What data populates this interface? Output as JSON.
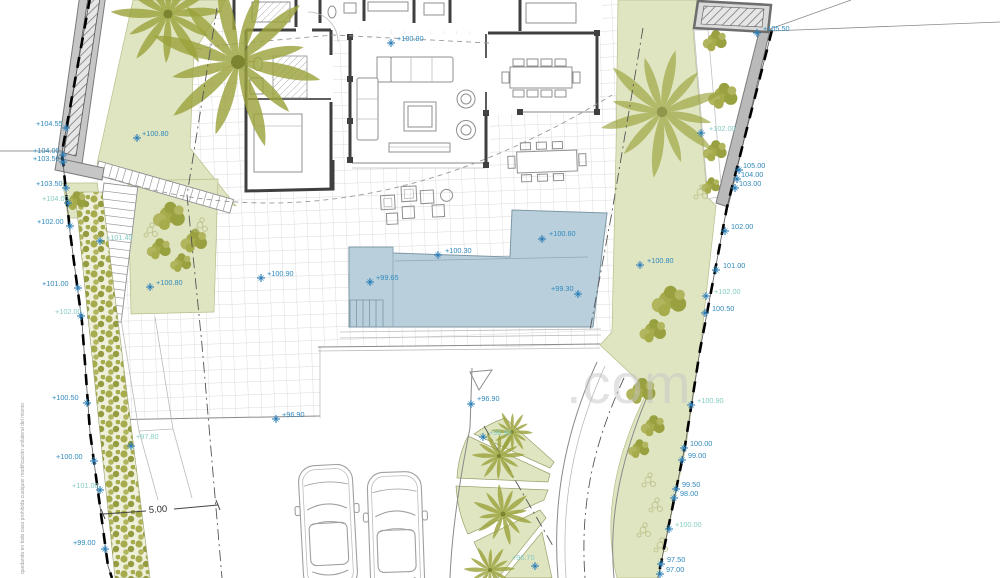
{
  "plan": {
    "watermark": ".com",
    "disclaimer_vertical_text": "quedando en todo caso prohibida cualquier modificación unilateral del mismo",
    "dimension_label": "5.00",
    "colors": {
      "pool": "#b9cfdc",
      "garden": "#e0e5c1",
      "foliage": "#9ba23c",
      "hedge": "#a6ab4c",
      "wall_gray": "#b9b9b9",
      "label_blue": "#3089bb",
      "label_teal": "#85ccc2",
      "watermark_gray": "#c6c6c6"
    },
    "elevation_labels": [
      {
        "t": "+104.55",
        "x": 36,
        "y": 126,
        "color": "blue",
        "kx": 66,
        "ky": 128
      },
      {
        "t": "+104.00",
        "x": 33,
        "y": 153,
        "color": "blue",
        "kx": 63,
        "ky": 155
      },
      {
        "t": "+103.50",
        "x": 33,
        "y": 161,
        "color": "blue",
        "kx": 63,
        "ky": 162
      },
      {
        "t": "+103.50",
        "x": 36,
        "y": 186,
        "color": "blue",
        "kx": 66,
        "ky": 188
      },
      {
        "t": "+104.00",
        "x": 42,
        "y": 201,
        "color": "teal",
        "kx": 68,
        "ky": 203
      },
      {
        "t": "+102.00",
        "x": 37,
        "y": 224,
        "color": "blue",
        "kx": 70,
        "ky": 226
      },
      {
        "t": "+101.00",
        "x": 42,
        "y": 286,
        "color": "blue",
        "kx": 78,
        "ky": 288
      },
      {
        "t": "+102.00",
        "x": 55,
        "y": 314,
        "color": "teal",
        "kx": 81,
        "ky": 316
      },
      {
        "t": "+101.40",
        "x": 106,
        "y": 240,
        "color": "teal",
        "kx": 100,
        "ky": 241
      },
      {
        "t": "+100.50",
        "x": 52,
        "y": 400,
        "color": "blue",
        "kx": 87,
        "ky": 403
      },
      {
        "t": "+100.00",
        "x": 56,
        "y": 459,
        "color": "blue",
        "kx": 94,
        "ky": 461
      },
      {
        "t": "+101.00",
        "x": 72,
        "y": 488,
        "color": "teal",
        "kx": 100,
        "ky": 490
      },
      {
        "t": "+97.80",
        "x": 136,
        "y": 439,
        "color": "teal",
        "kx": 131,
        "ky": 446
      },
      {
        "t": "+99.00",
        "x": 73,
        "y": 545,
        "color": "blue",
        "kx": 105,
        "ky": 549
      },
      {
        "t": "+100.80",
        "x": 142,
        "y": 136,
        "color": "blue",
        "kx": 137,
        "ky": 138
      },
      {
        "t": "+100.80",
        "x": 156,
        "y": 285,
        "color": "blue",
        "kx": 150,
        "ky": 287
      },
      {
        "t": "+100.90",
        "x": 267,
        "y": 276,
        "color": "blue",
        "kx": 261,
        "ky": 278
      },
      {
        "t": "+100.90",
        "x": 397,
        "y": 41,
        "color": "blue",
        "kx": 391,
        "ky": 43
      },
      {
        "t": "+100.80",
        "x": 647,
        "y": 263,
        "color": "blue",
        "kx": 640,
        "ky": 265
      },
      {
        "t": "+100.60",
        "x": 549,
        "y": 236,
        "color": "blue",
        "kx": 542,
        "ky": 239
      },
      {
        "t": "+100.30",
        "x": 445,
        "y": 253,
        "color": "blue",
        "kx": 438,
        "ky": 255
      },
      {
        "t": "+99.65",
        "x": 376,
        "y": 280,
        "color": "blue",
        "kx": 370,
        "ky": 282
      },
      {
        "t": "+99.30",
        "x": 551,
        "y": 291,
        "color": "blue",
        "kx": 578,
        "ky": 294
      },
      {
        "t": "+96.90",
        "x": 282,
        "y": 417,
        "color": "blue",
        "kx": 276,
        "ky": 419
      },
      {
        "t": "+96.90",
        "x": 477,
        "y": 401,
        "color": "blue",
        "kx": 471,
        "ky": 404
      },
      {
        "t": "+96.90",
        "x": 489,
        "y": 435,
        "color": "teal",
        "kx": 483,
        "ky": 437
      },
      {
        "t": "+96.70",
        "x": 512,
        "y": 560,
        "color": "teal",
        "kx": 535,
        "ky": 566
      },
      {
        "t": "+105.50",
        "x": 763,
        "y": 31,
        "color": "blue",
        "kx": 757,
        "ky": 33
      },
      {
        "t": "+102.00",
        "x": 709,
        "y": 131,
        "color": "teal",
        "kx": 701,
        "ky": 133
      },
      {
        "t": "105.00",
        "x": 743,
        "y": 168,
        "color": "blue",
        "kx": 739,
        "ky": 170
      },
      {
        "t": "104.00",
        "x": 741,
        "y": 177,
        "color": "blue",
        "kx": 737,
        "ky": 179
      },
      {
        "t": "103.00",
        "x": 739,
        "y": 186,
        "color": "blue",
        "kx": 735,
        "ky": 188
      },
      {
        "t": "102.00",
        "x": 731,
        "y": 229,
        "color": "blue",
        "kx": 725,
        "ky": 231
      },
      {
        "t": "101.00",
        "x": 723,
        "y": 268,
        "color": "blue",
        "kx": 716,
        "ky": 270
      },
      {
        "t": "+102.00",
        "x": 714,
        "y": 294,
        "color": "teal",
        "kx": 706,
        "ky": 296
      },
      {
        "t": "100.50",
        "x": 712,
        "y": 311,
        "color": "blue",
        "kx": 705,
        "ky": 313
      },
      {
        "t": "+100.90",
        "x": 697,
        "y": 403,
        "color": "teal",
        "kx": 691,
        "ky": 405
      },
      {
        "t": "100.00",
        "x": 690,
        "y": 446,
        "color": "blue",
        "kx": 684,
        "ky": 448
      },
      {
        "t": "99.00",
        "x": 688,
        "y": 458,
        "color": "blue",
        "kx": 682,
        "ky": 460
      },
      {
        "t": "99.50",
        "x": 682,
        "y": 487,
        "color": "blue",
        "kx": 676,
        "ky": 489
      },
      {
        "t": "98.00",
        "x": 680,
        "y": 496,
        "color": "blue",
        "kx": 674,
        "ky": 498
      },
      {
        "t": "+100.00",
        "x": 675,
        "y": 527,
        "color": "teal",
        "kx": 669,
        "ky": 529
      },
      {
        "t": "97.50",
        "x": 667,
        "y": 562,
        "color": "blue",
        "kx": 661,
        "ky": 564
      },
      {
        "t": "97.00",
        "x": 666,
        "y": 572,
        "color": "blue",
        "kx": 660,
        "ky": 574
      }
    ]
  }
}
